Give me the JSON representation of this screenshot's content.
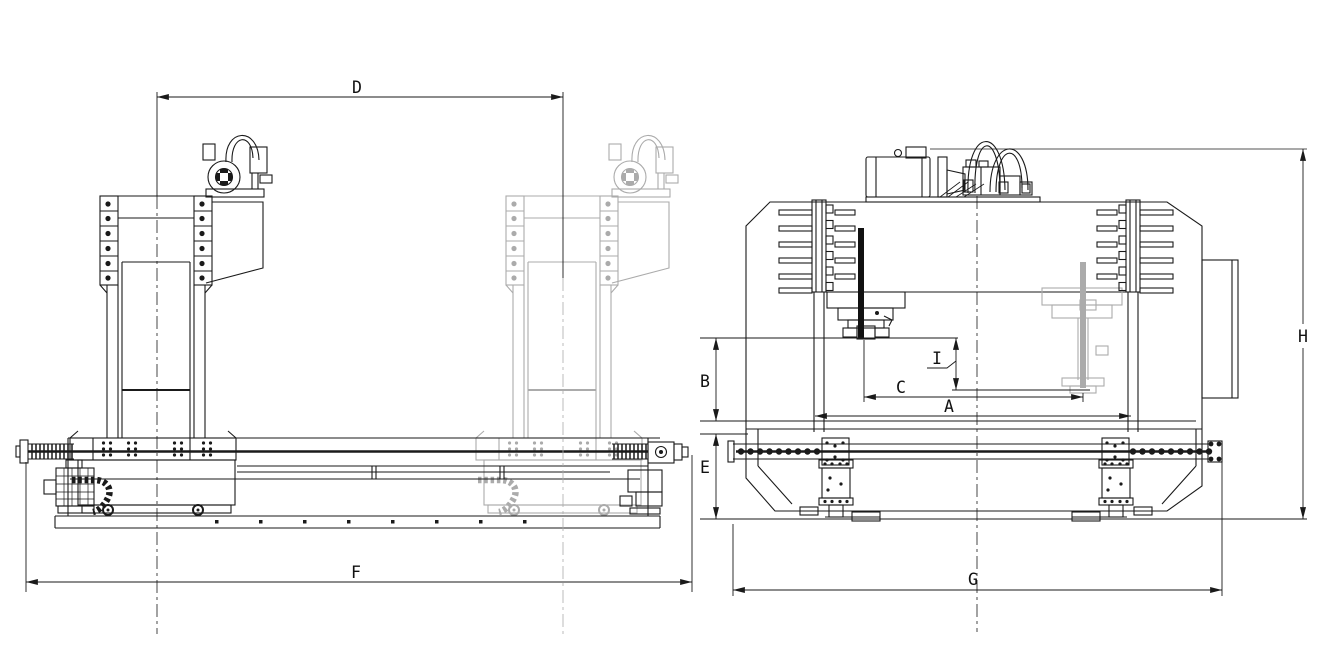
{
  "canvas": {
    "background": "#ffffff",
    "line_color": "#1a1a1a",
    "ghost_line_color": "#ababab"
  },
  "dimension_labels": {
    "A": "A",
    "B": "B",
    "C": "C",
    "D": "D",
    "E": "E",
    "F": "F",
    "G": "G",
    "H": "H",
    "I": "I"
  }
}
